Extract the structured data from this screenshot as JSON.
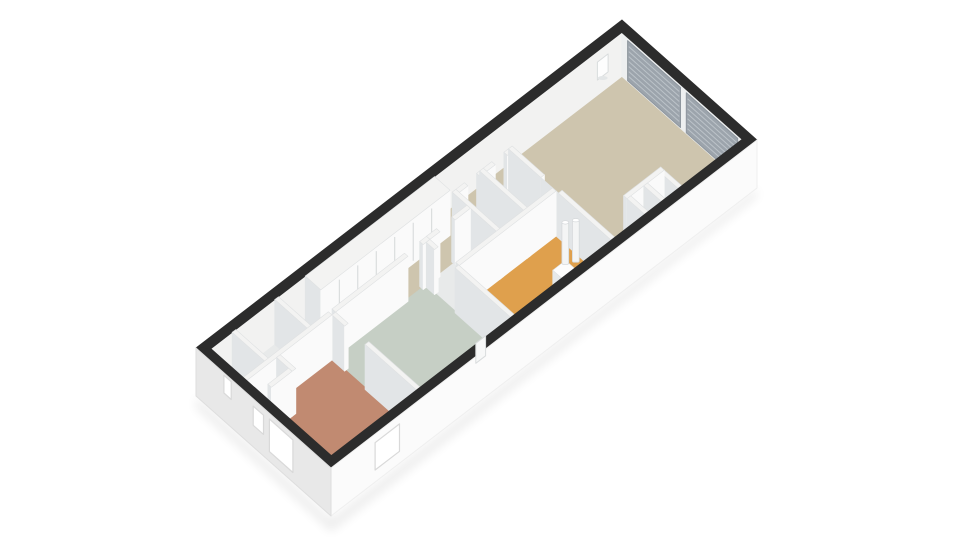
{
  "app": {
    "title": "3D floor plan render",
    "background": "#ffffff"
  },
  "view": {
    "origin": [
      196,
      345
    ],
    "u": [
      30.43,
      -23.43
    ],
    "v": [
      29.35,
      26.09
    ],
    "building_length_m": 14.0,
    "building_width_m": 4.6,
    "inner_a": [
      0.25,
      13.75
    ],
    "inner_b": [
      0.25,
      4.35
    ],
    "wall_top_dz": 3,
    "floor_dz": 48,
    "ext_bottom_dz": 51
  },
  "colors": {
    "band": "#2c2c2c",
    "ext_face_se": "#fbfbfb",
    "ext_face_sw": "#e8e8e8",
    "inner_face_nw": "#f2f2f1",
    "inner_face_ne": "#edeff0",
    "window_panel": "#9ca4ac",
    "window_stripe": "#bcc3c9",
    "wall_top": "#f3f3f2",
    "wall_face_se": "#fafafa",
    "wall_face_sw": "#e2e5e7",
    "wall_edge": "#dfe1e2",
    "opening_fill": "#ffffff",
    "opening_edge": "#d9d9d9",
    "fixture_white": "#f4f5f5",
    "door_wood": "#c5854a",
    "shadow": "#000000"
  },
  "floorplan": {
    "rooms": [
      {
        "name": "entry-wc",
        "rect": [
          0.25,
          0.25,
          1.01,
          1.41
        ],
        "color": "#e8eaea"
      },
      {
        "name": "entry-storage",
        "rect": [
          1.01,
          0.25,
          2.41,
          1.41
        ],
        "color": "#e8eaea"
      },
      {
        "name": "bedroom",
        "rect": [
          0.25,
          1.41,
          3.11,
          4.35
        ],
        "color": "#c18a71"
      },
      {
        "name": "corridor",
        "rect": [
          2.41,
          0.25,
          7.66,
          1.41
        ],
        "color": "#cec5ae"
      },
      {
        "name": "passage",
        "rect": [
          7.66,
          0.25,
          9.51,
          0.91
        ],
        "color": "#cec5ae"
      },
      {
        "name": "green-room",
        "rect": [
          3.11,
          1.41,
          6.21,
          4.35
        ],
        "color": "#c6cfc5"
      },
      {
        "name": "bathroom",
        "rect": [
          6.21,
          1.41,
          7.66,
          2.41
        ],
        "color": "#e8eaea"
      },
      {
        "name": "shower-room",
        "rect": [
          7.66,
          0.91,
          8.56,
          2.41
        ],
        "color": "#e8eaea"
      },
      {
        "name": "toilet-room",
        "rect": [
          8.56,
          0.91,
          9.51,
          2.41
        ],
        "color": "#e8eaea"
      },
      {
        "name": "kitchen",
        "rect": [
          6.21,
          2.41,
          9.51,
          4.35
        ],
        "color": "#dfa04d"
      },
      {
        "name": "living-room",
        "rect": [
          9.51,
          0.25,
          13.75,
          4.35
        ],
        "color": "#cec5ae"
      },
      {
        "name": "niche-a",
        "rect": [
          10.61,
          3.69,
          11.16,
          4.35
        ],
        "color": "#dadde0"
      },
      {
        "name": "niche-b",
        "rect": [
          11.16,
          3.69,
          11.71,
          4.35
        ],
        "color": "#dadde0"
      }
    ],
    "interior_walls": [
      {
        "id": "entry-divider",
        "rect": [
          0.95,
          0.25,
          1.07,
          1.41
        ]
      },
      {
        "id": "entry-corridor",
        "rect": [
          2.35,
          0.25,
          2.47,
          1.41
        ]
      },
      {
        "id": "entry-bedroom",
        "rect": [
          0.25,
          1.35,
          3.05,
          1.47
        ]
      },
      {
        "id": "bedroom-green-a",
        "rect": [
          3.05,
          1.47,
          3.17,
          1.9
        ]
      },
      {
        "id": "bedroom-green-b",
        "rect": [
          3.05,
          2.6,
          3.17,
          4.35
        ]
      },
      {
        "id": "corridor-green-a",
        "rect": [
          3.17,
          1.35,
          5.55,
          1.47
        ]
      },
      {
        "id": "corridor-green-b",
        "rect": [
          6.05,
          1.35,
          6.27,
          1.47
        ]
      },
      {
        "id": "green-kitchen-a",
        "rect": [
          6.15,
          1.47,
          6.27,
          1.75
        ]
      },
      {
        "id": "green-kitchen-b",
        "rect": [
          6.15,
          2.45,
          6.27,
          4.35
        ]
      },
      {
        "id": "corridor-bath-a",
        "rect": [
          6.27,
          1.35,
          6.6,
          1.47
        ]
      },
      {
        "id": "corridor-bath-b",
        "rect": [
          7.1,
          1.35,
          7.6,
          1.47
        ]
      },
      {
        "id": "bath-kitchen-long",
        "rect": [
          6.27,
          2.35,
          9.45,
          2.47
        ]
      },
      {
        "id": "bath-shower-div",
        "rect": [
          7.6,
          0.85,
          7.72,
          2.47
        ]
      },
      {
        "id": "passage-shower-a",
        "rect": [
          7.72,
          0.85,
          8.0,
          0.97
        ]
      },
      {
        "id": "passage-shower-b",
        "rect": [
          8.4,
          0.85,
          8.5,
          0.97
        ]
      },
      {
        "id": "shower-toilet-div",
        "rect": [
          8.5,
          0.85,
          8.62,
          2.47
        ]
      },
      {
        "id": "passage-toilet-a",
        "rect": [
          8.62,
          0.85,
          8.9,
          0.97
        ]
      },
      {
        "id": "passage-toilet-b",
        "rect": [
          9.3,
          0.85,
          9.45,
          0.97
        ]
      },
      {
        "id": "living-wall-a",
        "rect": [
          9.45,
          0.85,
          9.57,
          1.95
        ]
      },
      {
        "id": "living-door",
        "rect": [
          9.45,
          1.95,
          9.57,
          2.55
        ],
        "door": true
      },
      {
        "id": "living-wall-b",
        "rect": [
          9.45,
          2.55,
          9.57,
          4.35
        ]
      },
      {
        "id": "niche-wall-1",
        "rect": [
          10.55,
          3.75,
          10.67,
          4.35
        ]
      },
      {
        "id": "niche-wall-2",
        "rect": [
          11.1,
          3.75,
          11.22,
          4.35
        ]
      },
      {
        "id": "niche-wall-3",
        "rect": [
          11.65,
          3.75,
          11.77,
          4.35
        ]
      },
      {
        "id": "niche-front",
        "rect": [
          10.55,
          3.63,
          11.77,
          3.75
        ]
      },
      {
        "id": "bedroom-closet-a",
        "rect": [
          1.23,
          1.47,
          1.35,
          2.0
        ]
      },
      {
        "id": "bedroom-closet-b",
        "rect": [
          0.55,
          1.88,
          1.23,
          2.0
        ]
      },
      {
        "id": "closet-run",
        "rect": [
          3.35,
          0.25,
          7.6,
          0.78
        ],
        "seams": 6
      }
    ],
    "ne_window_panels": [
      {
        "from": 0.45,
        "to": 2.25
      },
      {
        "from": 2.45,
        "to": 4.2
      }
    ],
    "exterior_openings": [
      {
        "face": "SW",
        "from": 2.5,
        "to": 3.3,
        "top": 0.12,
        "bottom": 0.8
      },
      {
        "face": "SW",
        "from": 1.95,
        "to": 2.3,
        "top": 0.15,
        "bottom": 0.55
      },
      {
        "face": "SW",
        "from": 0.95,
        "to": 1.2,
        "top": 0.05,
        "bottom": 0.42
      },
      {
        "face": "SE",
        "from": 1.45,
        "to": 2.25,
        "top": 0.18,
        "bottom": 0.75
      }
    ],
    "fixtures": [
      {
        "id": "pipe-1",
        "type": "pipe",
        "at": [
          9.05,
          3.2
        ]
      },
      {
        "id": "pipe-2",
        "type": "pipe",
        "at": [
          9.28,
          3.32
        ]
      },
      {
        "id": "step-ladder",
        "type": "box",
        "rect": [
          8.3,
          3.55,
          8.72,
          3.95
        ],
        "top_dz": 24
      },
      {
        "id": "nw-wall-unit",
        "type": "wallbox",
        "a0": 12.95,
        "a1": 13.3,
        "z1": 14,
        "z2": 32
      },
      {
        "id": "se-wall-unit",
        "type": "sebox",
        "a0": 5.0,
        "a1": 5.32,
        "z1": 2,
        "z2": 22
      }
    ]
  }
}
